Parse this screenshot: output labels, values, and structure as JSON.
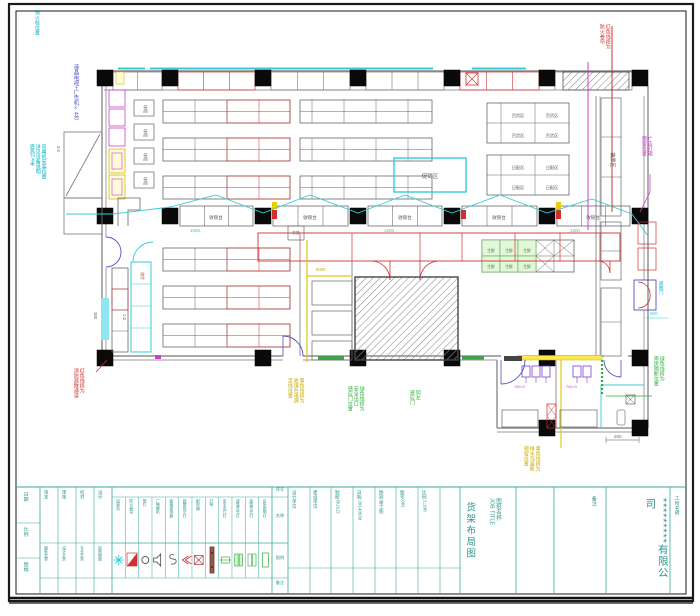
{
  "sheet": {
    "company": "*********有限公司",
    "project_label": "工程名称:",
    "job_title_label": "图纸名称:\nJOB TITLE",
    "drawing_name": "货架布局图",
    "note_label": "备注:"
  },
  "title_block": {
    "left_col": [
      "日期",
      "比例",
      "图幅"
    ],
    "approval": [
      {
        "label": "审定",
        "value": "图纸会审"
      },
      {
        "label": "审核",
        "value": "设计负责"
      },
      {
        "label": "校对",
        "value": "专业负责"
      },
      {
        "label": "设计",
        "value": "绘图制图"
      }
    ],
    "info_cols": [
      "设计单位:",
      "建设单位:",
      "制图:BUILD",
      "日期:20140530",
      "图别:竣工图",
      "图号:001",
      "比例:1:100"
    ],
    "legend": {
      "headers": {
        "no": "序号",
        "name": "名称",
        "symbol": "图例",
        "note": "备注"
      },
      "items": [
        {
          "name": "风幕机",
          "type": "star"
        },
        {
          "name": "防火卷帘",
          "type": "flag"
        },
        {
          "name": "筒灯",
          "type": "circle"
        },
        {
          "name": "广播喇叭",
          "type": "horn"
        },
        {
          "name": "感烟探测器",
          "type": "squig"
        },
        {
          "name": "疏散指示灯",
          "type": "arrow"
        },
        {
          "name": "配电箱",
          "type": "xbox"
        },
        {
          "name": "灯带",
          "type": "bar"
        },
        {
          "name": "安全出口灯",
          "type": "clip"
        },
        {
          "name": "双管荧光灯",
          "type": "dbl"
        },
        {
          "name": "单管荧光灯",
          "type": "dbl2"
        },
        {
          "name": "应急照明灯",
          "type": "rectg"
        }
      ]
    }
  },
  "labels": {
    "checkout": "收银台",
    "dept": "百货区",
    "daily": "日配区",
    "fresh": "生鲜",
    "promo": "促销区",
    "corridor": "蔬果区",
    "small_box": "冰柜",
    "receive": "收货",
    "note": "防损"
  },
  "annotations": {
    "lcd": "液晶电视+广告机×4台",
    "hydrant": "消火栓位置",
    "air_curtain": "风幕机安装位置\n详见设备说明\n底高2.4米",
    "red_exit": "红色线段为\n消防疏散通道",
    "yellow_cable": "黄色线段为\n收银台电源\n走线位置",
    "green_door": "绿色线段为\n安全出口\n感应门位置",
    "green_door2": "同左\n感应门",
    "yellow_drain": "黄色线段为\n排水沟盖板\n预留位置",
    "green_partition": "绿色线段为\n库房隔断位置",
    "red_curtain": "红色线段为\n防火卷帘",
    "ad_box": "广告灯箱\n预留位置",
    "evac_door": "疏散门"
  },
  "dims": {
    "d1500": "1500",
    "d800": "800",
    "d200": "200",
    "d300": "300",
    "d10": "1.0",
    "d5000": "5000",
    "d20": "2.0",
    "d700": "700×3"
  }
}
